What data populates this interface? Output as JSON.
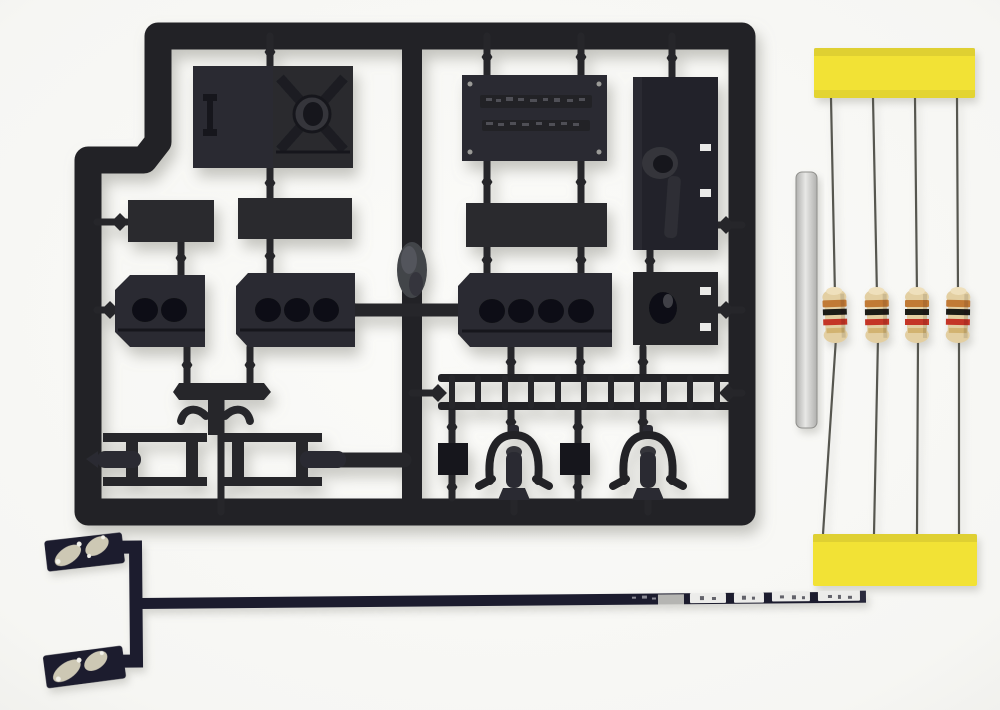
{
  "scene": {
    "description": "Product photo of a model railway detailing kit on a white background: a black injection-moulded plastic sprue of detail parts (panels, builders plate, drilled plates, ladder, window frames, stirrup steps), four axial carbon-film resistors taped between two yellow foam strips, one small silver metal tube, and an L-shaped dark flexible PCB lighting strip with soldered pads and white LED segments.",
    "objects": [
      {
        "name": "parts-sprue",
        "material": "black styrene",
        "position": "upper left"
      },
      {
        "name": "resistor-set",
        "position": "right"
      },
      {
        "name": "metal-tube",
        "position": "right, beside resistors"
      },
      {
        "name": "flex-pcb-strip",
        "position": "bottom"
      }
    ]
  },
  "sprue": {
    "parts": [
      {
        "name": "panel-with-i-emboss"
      },
      {
        "name": "panel-with-x-boss"
      },
      {
        "name": "builders-plate",
        "rivet_count": 4,
        "text_rows": 2,
        "note": "embossed text illegible"
      },
      {
        "name": "tall-bracket-panel",
        "slot_count": 2
      },
      {
        "name": "plain-bar",
        "count": 3
      },
      {
        "name": "plate-2-holes",
        "hole_count": 2
      },
      {
        "name": "plate-3-holes",
        "hole_count": 3
      },
      {
        "name": "plate-4-holes",
        "hole_count": 4
      },
      {
        "name": "boss-plate",
        "hole_count": 1,
        "slot_count": 2
      },
      {
        "name": "footboard-plank"
      },
      {
        "name": "handle-bracket"
      },
      {
        "name": "ladder",
        "rung_count": 11
      },
      {
        "name": "window-frame",
        "count": 2
      },
      {
        "name": "square-block",
        "count": 2
      },
      {
        "name": "stirrup-step",
        "count": 2
      }
    ]
  },
  "resistors": {
    "count": 4,
    "band_colors": [
      "orange",
      "black",
      "red",
      "gold"
    ],
    "mounting": "leads taped into two yellow foam strips, top and bottom"
  },
  "foam_strips": {
    "count": 2,
    "color_name": "yellow"
  },
  "metal_tube": {
    "count": 1,
    "finish": "silver"
  },
  "flex_pcb": {
    "shape": "C-shaped solder pad end feeding a long thin strip",
    "solder_pads": 2,
    "white_led_segments": 4,
    "silver_segment": 1
  },
  "palette": {
    "bg": "#f8f8f5",
    "sprue": "#222327",
    "sprue_part": "#2b2c30",
    "sprue_gate": "#26272b",
    "sprue_dark": "#17181c",
    "sprue_light": "#34353b",
    "hole": "#0f1013",
    "slot_white": "#eaeae8",
    "yellow": "#f2e236",
    "wire": "#56564f",
    "res_body": "#e3cfa2",
    "band_orange": "#c17a36",
    "band_black": "#1f1c18",
    "band_red": "#c43528",
    "band_gold": "#cfae68",
    "tube_light": "#e8e8e6",
    "tube_dark": "#b0b0ae",
    "pcb": "#1b1b2f",
    "pad_silver": "#cdc8b4",
    "seg_white": "#ececea"
  }
}
